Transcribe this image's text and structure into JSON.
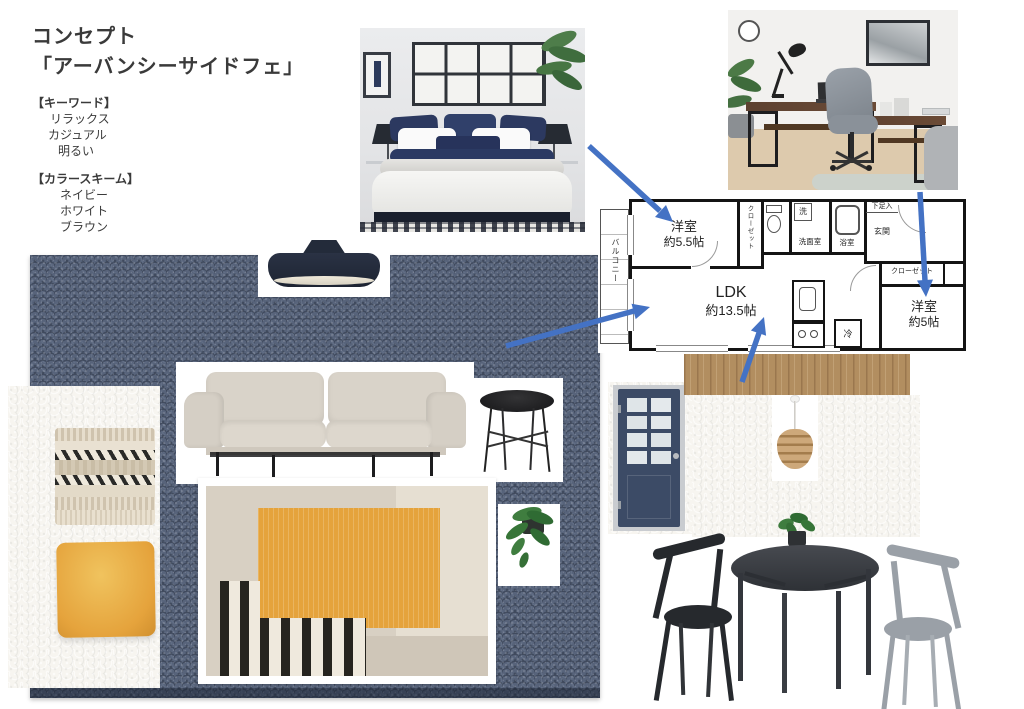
{
  "concept": {
    "title_line1": "コンセプト",
    "title_line2": "「アーバンシーサイドフェ」",
    "keywords_header": "【キーワード】",
    "keywords": [
      "リラックス",
      "カジュアル",
      "明るい"
    ],
    "colors_header": "【カラースキーム】",
    "colors": [
      "ネイビー",
      "ホワイト",
      "ブラウン"
    ]
  },
  "floorplan": {
    "balcony": "バルコニー",
    "bedroom1": {
      "name": "洋室",
      "size": "約5.5帖"
    },
    "closet_vertical": "クローゼット",
    "laundry": "洗",
    "washroom": "洗面室",
    "bathroom": "浴室",
    "shoe_box": "下足入",
    "entrance": "玄関",
    "ldk": {
      "name": "LDK",
      "size": "約13.5帖"
    },
    "closet_horizontal": "クローゼット",
    "bedroom2": {
      "name": "洋室",
      "size": "約5帖"
    },
    "fridge": "冷"
  },
  "palette": {
    "arrow-blue": "#4472c4",
    "carpet-navy": "#57637a",
    "navy-dark": "#232b3a",
    "mustard": "#e5a33c",
    "wood": "#b28e60",
    "door-navy": "#3c4b66",
    "sofa-greige": "#d9d3c9",
    "plaster": "#f7f5f0",
    "chair-black": "#26292d",
    "chair-gray": "#9aa0a7",
    "table-dark": "#383b41"
  }
}
